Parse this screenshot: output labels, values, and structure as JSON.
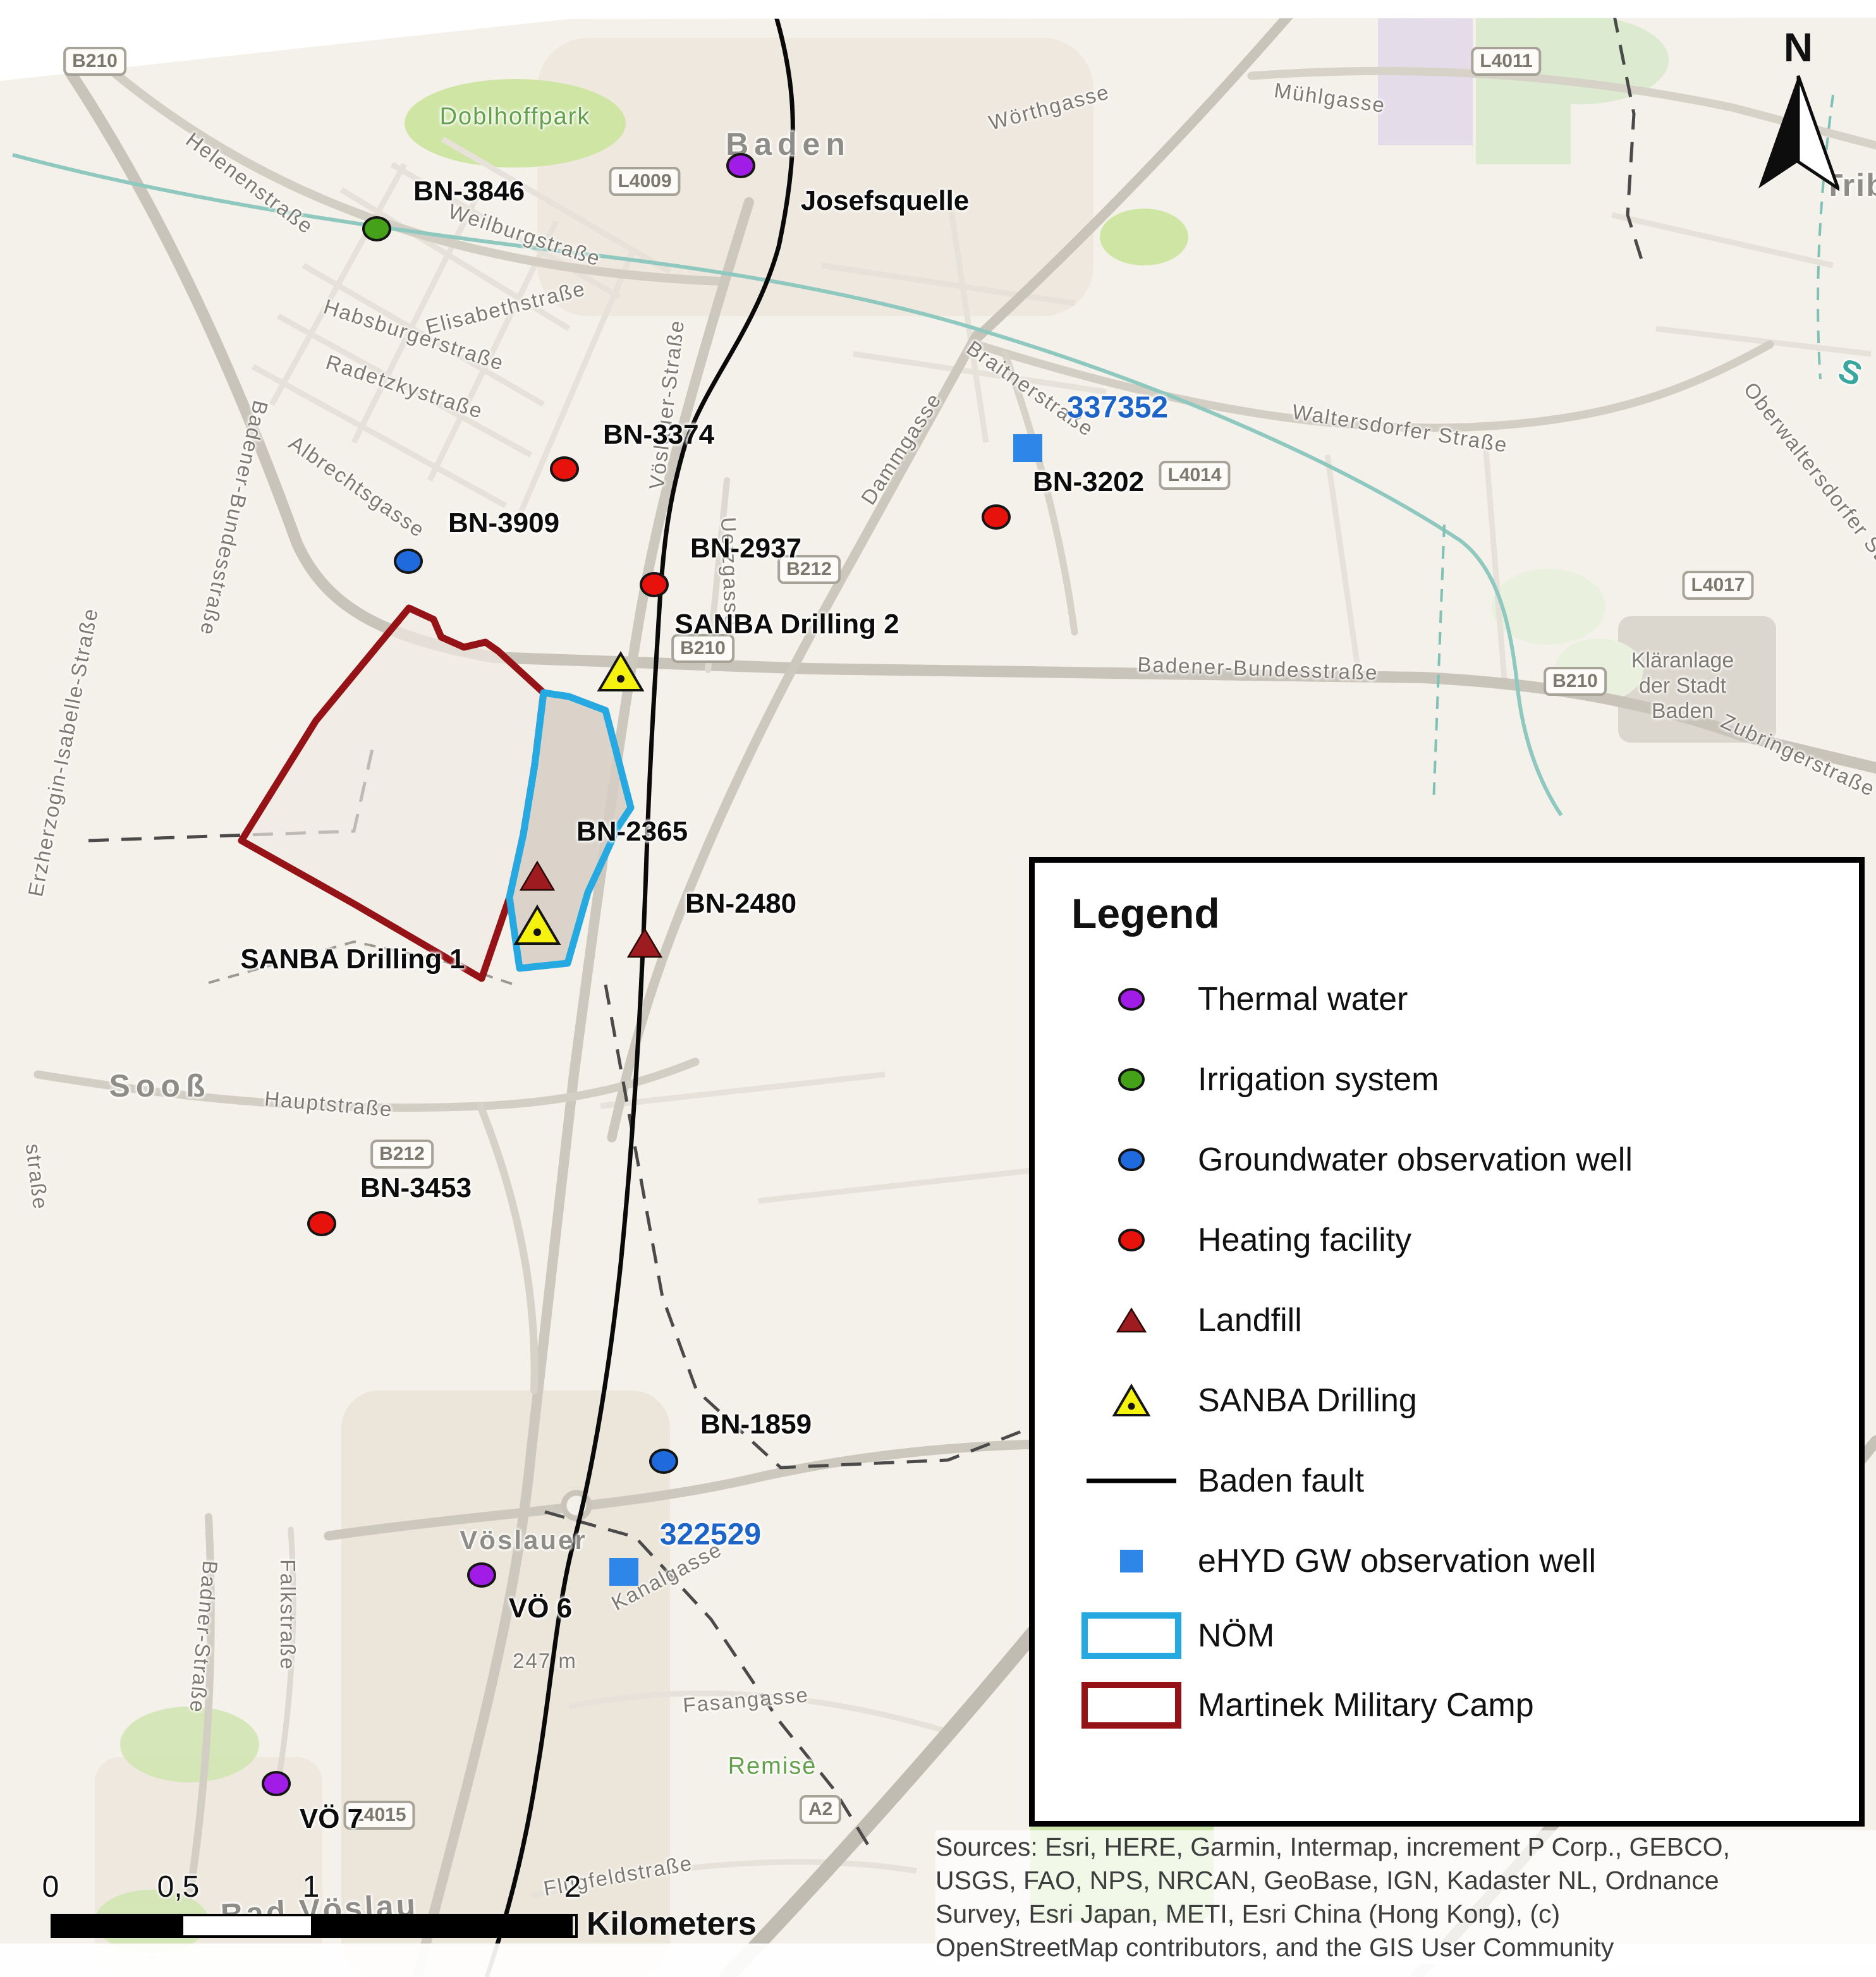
{
  "map": {
    "north_label": "N",
    "city_labels": [
      "Baden",
      "Sooß",
      "Bad Vöslau",
      "Tribuswinkel",
      "Vöslauer"
    ],
    "street_labels": [
      "Helenenstraße",
      "Badener-Bundesstraße",
      "Erzherzogin-Isabelle-Straße",
      "Doblhoffpark",
      "Weilburgstraße",
      "Elisabethstraße",
      "Habsburgerstraße",
      "Radetzkystraße",
      "Albrechtsgasse",
      "Vöslauer-Straße",
      "Wörthgasse",
      "Mühlgasse",
      "Braitnerstraße",
      "Dammgasse",
      "Waltersdorfer Straße",
      "Oberwaltersdorfer Straße",
      "Uetzgasse",
      "Badener-Bundesstraße",
      "Zubringerstraße",
      "Kläranlage\nder Stadt\nBaden",
      "Hauptstraße",
      "straße",
      "Badner-Straße",
      "Falkstraße",
      "Kanalgasse",
      "247 m",
      "Fasangasse",
      "Remise",
      "Flugfeldstraße",
      "S"
    ],
    "shields": [
      "B210",
      "L4009",
      "L4011",
      "L4014",
      "B212",
      "B210",
      "B210",
      "L4017",
      "B212",
      "A2",
      "L4015"
    ],
    "sites": [
      {
        "label": "Josefsquelle",
        "type": "thermal-water"
      },
      {
        "label": "BN-3846",
        "type": "irrigation-system"
      },
      {
        "label": "BN-3374",
        "type": "heating-facility"
      },
      {
        "label": "BN-3909",
        "type": "groundwater-observation-well"
      },
      {
        "label": "BN-2937",
        "type": "heating-facility"
      },
      {
        "label": "337352",
        "type": "ehyd-gw-observation-well"
      },
      {
        "label": "BN-3202",
        "type": "heating-facility"
      },
      {
        "label": "SANBA Drilling 2",
        "type": "sanba-drilling"
      },
      {
        "label": "BN-2365",
        "type": "landfill"
      },
      {
        "label": "SANBA Drilling 1",
        "type": "sanba-drilling"
      },
      {
        "label": "BN-2480",
        "type": "landfill"
      },
      {
        "label": "BN-3453",
        "type": "heating-facility"
      },
      {
        "label": "BN-1859",
        "type": "groundwater-observation-well"
      },
      {
        "label": "322529",
        "type": "ehyd-gw-observation-well"
      },
      {
        "label": "VÖ 6",
        "type": "thermal-water"
      },
      {
        "label": "VÖ 7",
        "type": "thermal-water"
      }
    ],
    "scale_bar": {
      "ticks": [
        "0",
        "0,5",
        "1",
        "2"
      ],
      "unit": "Kilometers"
    },
    "sources_lines": [
      "Sources: Esri, HERE, Garmin, Intermap, increment P Corp., GEBCO,",
      "USGS, FAO, NPS, NRCAN, GeoBase, IGN, Kadaster NL, Ordnance",
      "Survey, Esri Japan, METI, Esri China (Hong Kong), (c)",
      "OpenStreetMap contributors, and the GIS User Community"
    ]
  },
  "legend": {
    "title": "Legend",
    "items": [
      {
        "label": "Thermal water",
        "type": "circle",
        "color": "#A21CE8"
      },
      {
        "label": "Irrigation system",
        "type": "circle",
        "color": "#46A11A"
      },
      {
        "label": "Groundwater observation well",
        "type": "circle",
        "color": "#1F6BDE"
      },
      {
        "label": "Heating facility",
        "type": "circle",
        "color": "#E8120C"
      },
      {
        "label": "Landfill",
        "type": "triangle",
        "color": "#9E1B20"
      },
      {
        "label": "SANBA Drilling",
        "type": "triangle-dot",
        "color": "#F4F20E"
      },
      {
        "label": "Baden fault",
        "type": "line",
        "color": "#000000"
      },
      {
        "label": "eHYD GW observation well",
        "type": "square",
        "color": "#2E86E8"
      },
      {
        "label": "NÖM",
        "type": "outline",
        "color": "#25A9E0"
      },
      {
        "label": "Martinek Military Camp",
        "type": "outline",
        "color": "#951317"
      }
    ]
  },
  "colors": {
    "thermal_water": "#A21CE8",
    "irrigation": "#46A11A",
    "gw_well": "#1F6BDE",
    "heating": "#E8120C",
    "landfill": "#9E1B20",
    "sanba_yellow": "#F4F20E",
    "ehyd_blue": "#2E86E8",
    "nom_outline": "#25A9E0",
    "camp_outline": "#951317",
    "fault": "#000000",
    "blue_label_text": "#1C64C8"
  }
}
